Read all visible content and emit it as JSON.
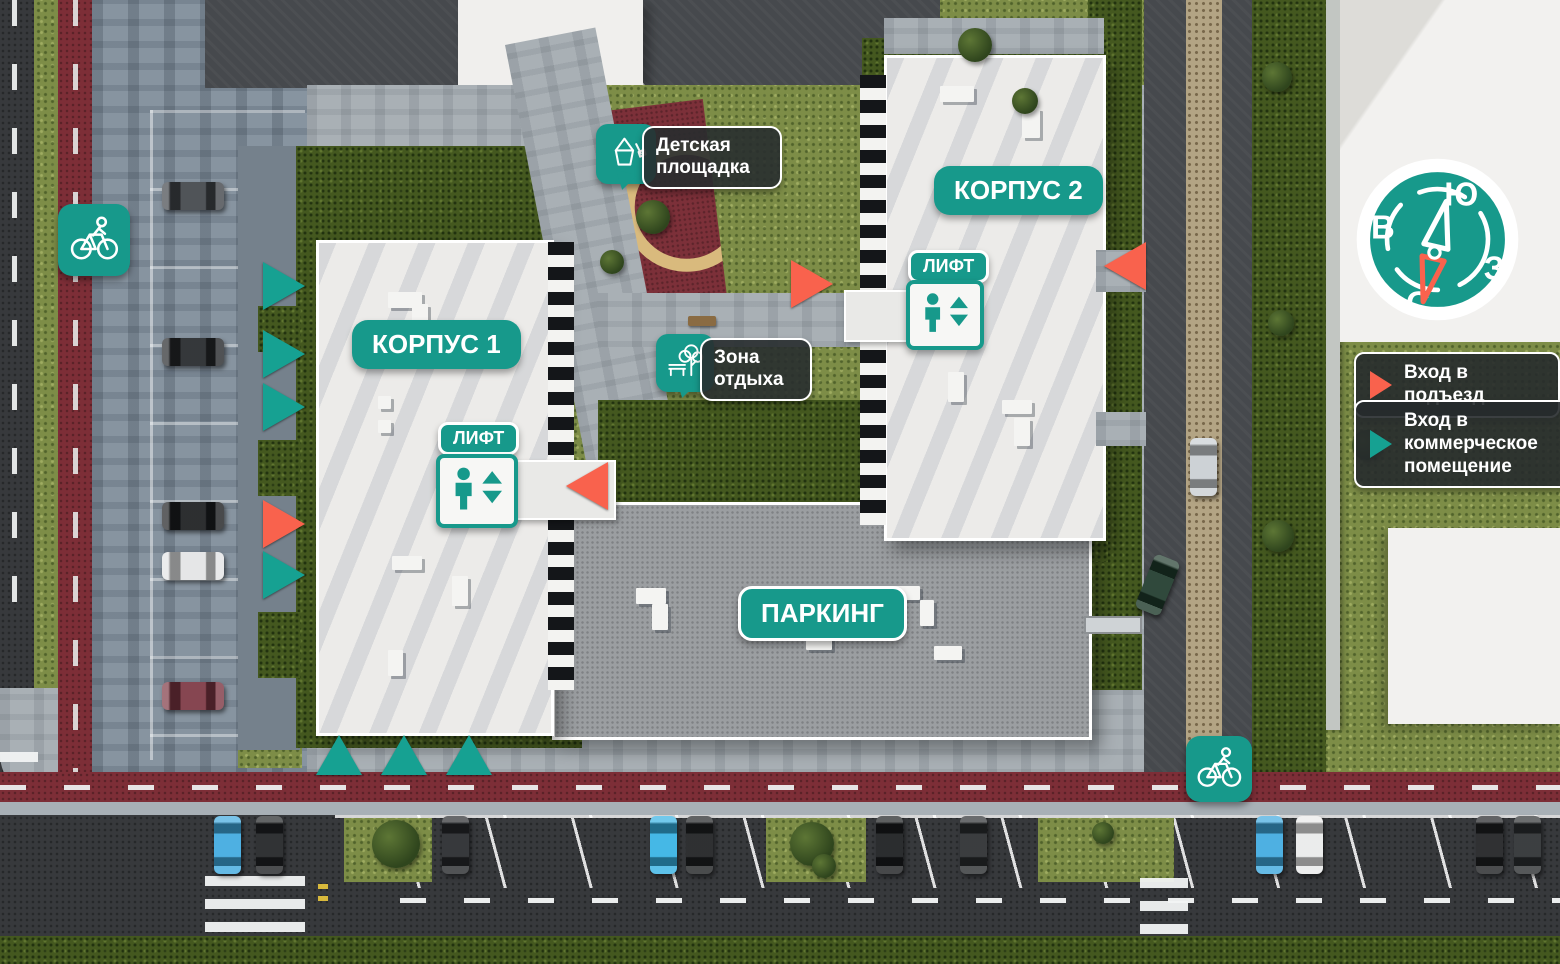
{
  "map_labels": {
    "building1": "КОРПУС 1",
    "building2": "КОРПУС 2",
    "parking_garage": "ПАРКИНГ",
    "elevator": "ЛИФТ",
    "playground": "Детская площадка",
    "rest_zone": "Зона отдыха"
  },
  "legend": {
    "items": [
      {
        "id": "entrance-residential",
        "label": "Вход в подъезд",
        "marker_color": "#f9624d",
        "marker_shape": "triangle-right"
      },
      {
        "id": "entrance-commercial",
        "label": "Вход в коммерческое помещение",
        "marker_color": "#16a192",
        "marker_shape": "triangle-right"
      }
    ]
  },
  "compass": {
    "top": "Ю",
    "left": "В",
    "right": "З",
    "bottom": "С",
    "needle_north_color": "#f9624d"
  },
  "icons": {
    "bike_path": "bicycle-icon",
    "elevator": "elevator-icon",
    "playground": "sand-bucket-icon",
    "rest_zone": "tree-bench-icon",
    "compass": "compass-dial-icon"
  },
  "colors": {
    "teal": "#16a192",
    "coral": "#f9624d",
    "label_dark_bg": "rgba(40,45,47,0.9)",
    "bike_path_red": "#7d2e37"
  },
  "markers": {
    "residential_entrances": [
      {
        "x": 263,
        "y": 500,
        "dir": "right"
      },
      {
        "x": 566,
        "y": 462,
        "dir": "left"
      },
      {
        "x": 791,
        "y": 260,
        "dir": "right"
      },
      {
        "x": 1104,
        "y": 242,
        "dir": "left"
      }
    ],
    "commercial_entrances": [
      {
        "x": 263,
        "y": 262,
        "dir": "right"
      },
      {
        "x": 263,
        "y": 330,
        "dir": "right"
      },
      {
        "x": 263,
        "y": 383,
        "dir": "right"
      },
      {
        "x": 263,
        "y": 551,
        "dir": "right"
      },
      {
        "x": 316,
        "y": 735,
        "dir": "up"
      },
      {
        "x": 381,
        "y": 735,
        "dir": "up"
      },
      {
        "x": 446,
        "y": 735,
        "dir": "up"
      }
    ]
  },
  "vehicles": {
    "left_lot": [
      {
        "x": 162,
        "y": 182,
        "color": "#41454a"
      },
      {
        "x": 162,
        "y": 338,
        "color": "#24272a"
      },
      {
        "x": 162,
        "y": 502,
        "color": "#1b1d1f"
      },
      {
        "x": 162,
        "y": 552,
        "color": "#e3e4e5"
      },
      {
        "x": 162,
        "y": 682,
        "color": "#7c3642"
      }
    ],
    "street_row": [
      {
        "x": 214,
        "y": 816,
        "color": "#3fa9df"
      },
      {
        "x": 256,
        "y": 816,
        "color": "#202224"
      },
      {
        "x": 442,
        "y": 816,
        "color": "#26282b"
      },
      {
        "x": 650,
        "y": 816,
        "color": "#35b2e4"
      },
      {
        "x": 686,
        "y": 816,
        "color": "#1d1f21"
      },
      {
        "x": 876,
        "y": 816,
        "color": "#191b1d"
      },
      {
        "x": 960,
        "y": 816,
        "color": "#2a2d2f"
      },
      {
        "x": 1256,
        "y": 816,
        "color": "#3fa9df"
      },
      {
        "x": 1296,
        "y": 816,
        "color": "#e9eaea"
      },
      {
        "x": 1476,
        "y": 816,
        "color": "#1e2022"
      },
      {
        "x": 1514,
        "y": 816,
        "color": "#2c2f31"
      }
    ],
    "right_road": [
      {
        "x": 1190,
        "y": 438,
        "color": "#c9ced2",
        "rot": 0
      },
      {
        "x": 1144,
        "y": 556,
        "color": "#1e3a2b",
        "rot": 22
      }
    ]
  }
}
